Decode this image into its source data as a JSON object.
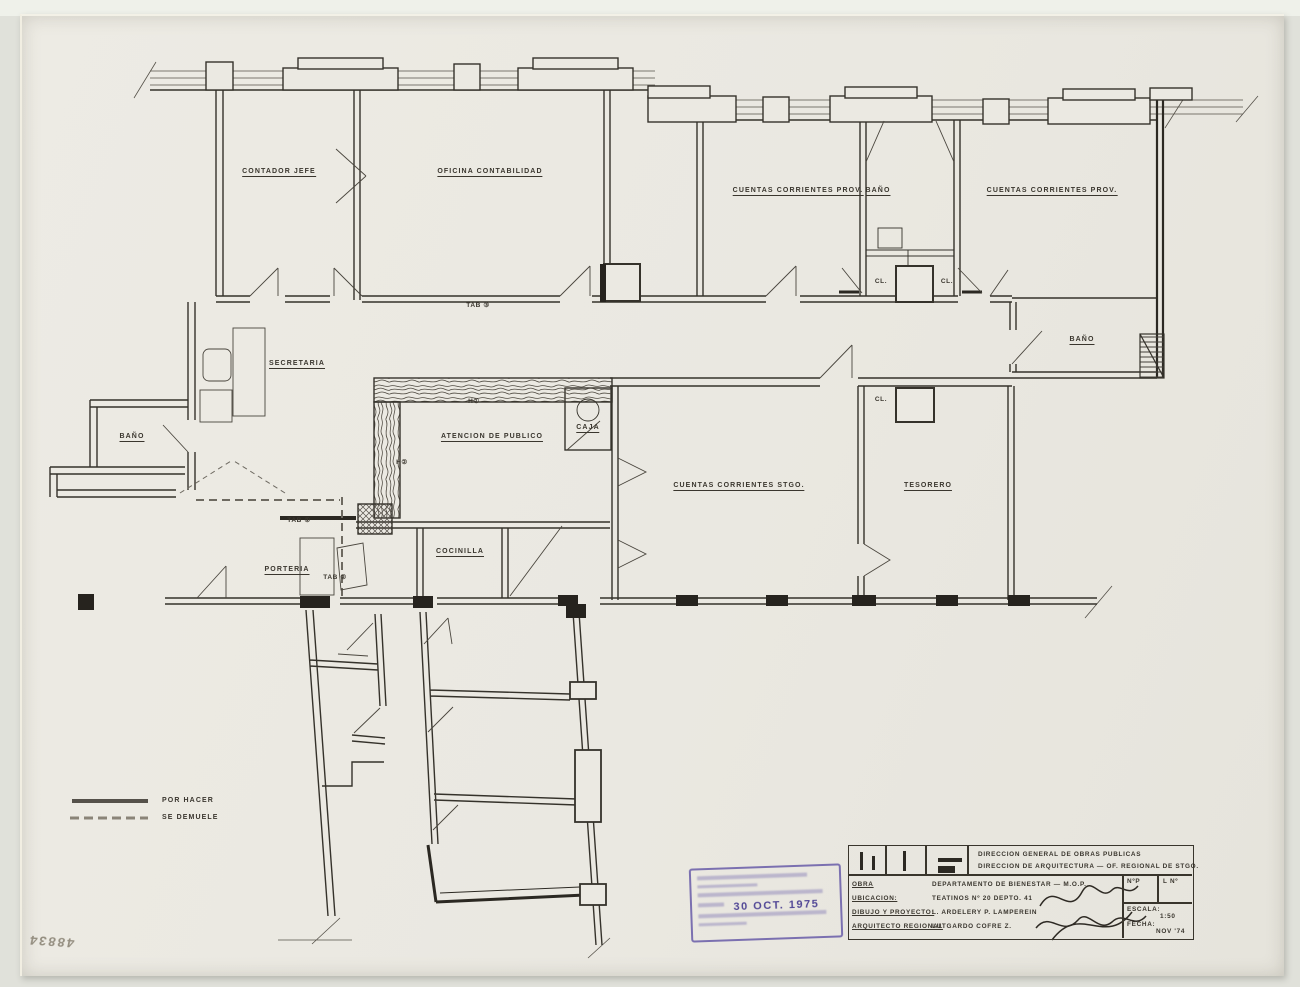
{
  "rooms": {
    "contador_jefe": "CONTADOR  JEFE",
    "oficina_contabilidad": "OFICINA  CONTABILIDAD",
    "ctas_prov_1": "CUENTAS  CORRIENTES  PROV.",
    "bano_top": "BAÑO",
    "ctas_prov_2": "CUENTAS  CORRIENTES  PROV.",
    "secretaria": "SECRETARIA",
    "bano_left": "BAÑO",
    "atencion": "ATENCION  DE  PUBLICO",
    "caja": "CAJA",
    "ctas_stgo": "CUENTAS  CORRIENTES  STGO.",
    "tesorero": "TESORERO",
    "bano_right": "BAÑO",
    "porteria": "PORTERIA",
    "cocinilla": "COCINILLA",
    "cl_1": "CL.",
    "cl_2": "CL.",
    "cl_3": "CL."
  },
  "tags": {
    "tab1": "TAB ①",
    "tab2": "TAB ②",
    "tab3": "TAB ③",
    "h1": "H①",
    "h2": "H②"
  },
  "legend": {
    "por_hacer": "POR HACER",
    "se_demuele": "SE DEMUELE"
  },
  "title_block": {
    "org_line1": "DIRECCION  GENERAL  DE  OBRAS  PUBLICAS",
    "org_line2": "DIRECCION  DE  ARQUITECTURA — OF. REGIONAL  DE  STGO.",
    "rows": [
      {
        "label": "OBRA",
        "value": "DEPARTAMENTO  DE  BIENESTAR — M.O.P."
      },
      {
        "label": "UBICACION:",
        "value": "TEATINOS  Nº 20   DEPTO. 41"
      },
      {
        "label": "DIBUJO Y PROYECTO:",
        "value": "L. ARDELERY    P. LAMPEREIN"
      },
      {
        "label": "ARQUITECTO REGIONAL",
        "value": "LUTGARDO  COFRE  Z."
      }
    ],
    "np_label": "NºP",
    "ln_label": "L Nº",
    "escala_label": "ESCALA:",
    "escala_value": "1:50",
    "fecha_label": "FECHA:",
    "fecha_value": "NOV '74"
  },
  "stamp": {
    "date": "30 OCT. 1975"
  },
  "handwritten_number": "48834"
}
